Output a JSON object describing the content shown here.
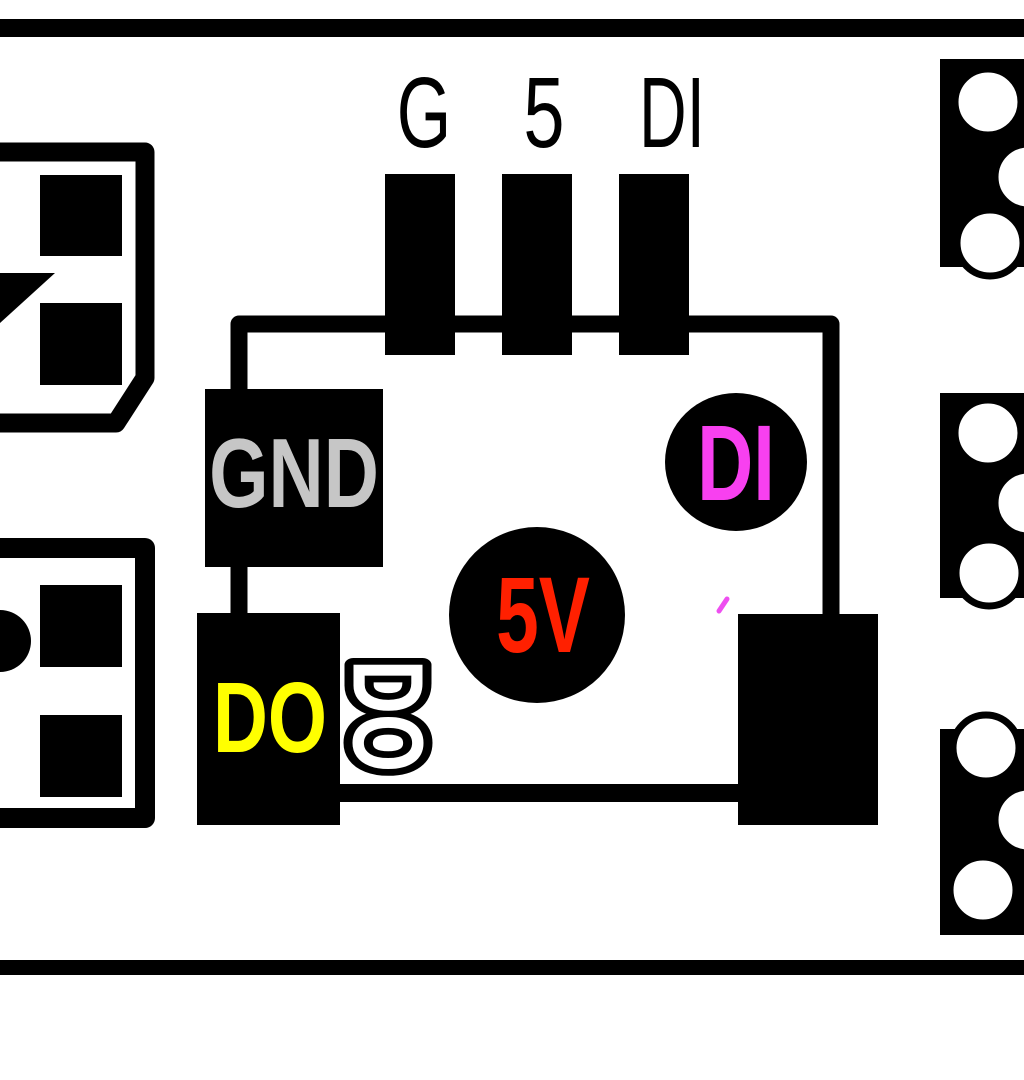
{
  "board": {
    "description": "LED module pinout diagram",
    "top_pin_labels": [
      {
        "label": "G"
      },
      {
        "label": "5"
      },
      {
        "label": "DI"
      }
    ],
    "pads": {
      "gnd": {
        "label": "GND",
        "color": "#c6c6c6"
      },
      "dout": {
        "label": "DO",
        "color": "#ffff00"
      },
      "dout_outline": {
        "label": "DO",
        "color": "#ffffff"
      },
      "v5": {
        "label": "5V",
        "color": "#ff2000"
      },
      "din": {
        "label": "DI",
        "color": "#f840f0"
      }
    },
    "colors": {
      "ink": "#000000",
      "background": "#ffffff",
      "stray_mark": "#ee4ff0"
    }
  }
}
